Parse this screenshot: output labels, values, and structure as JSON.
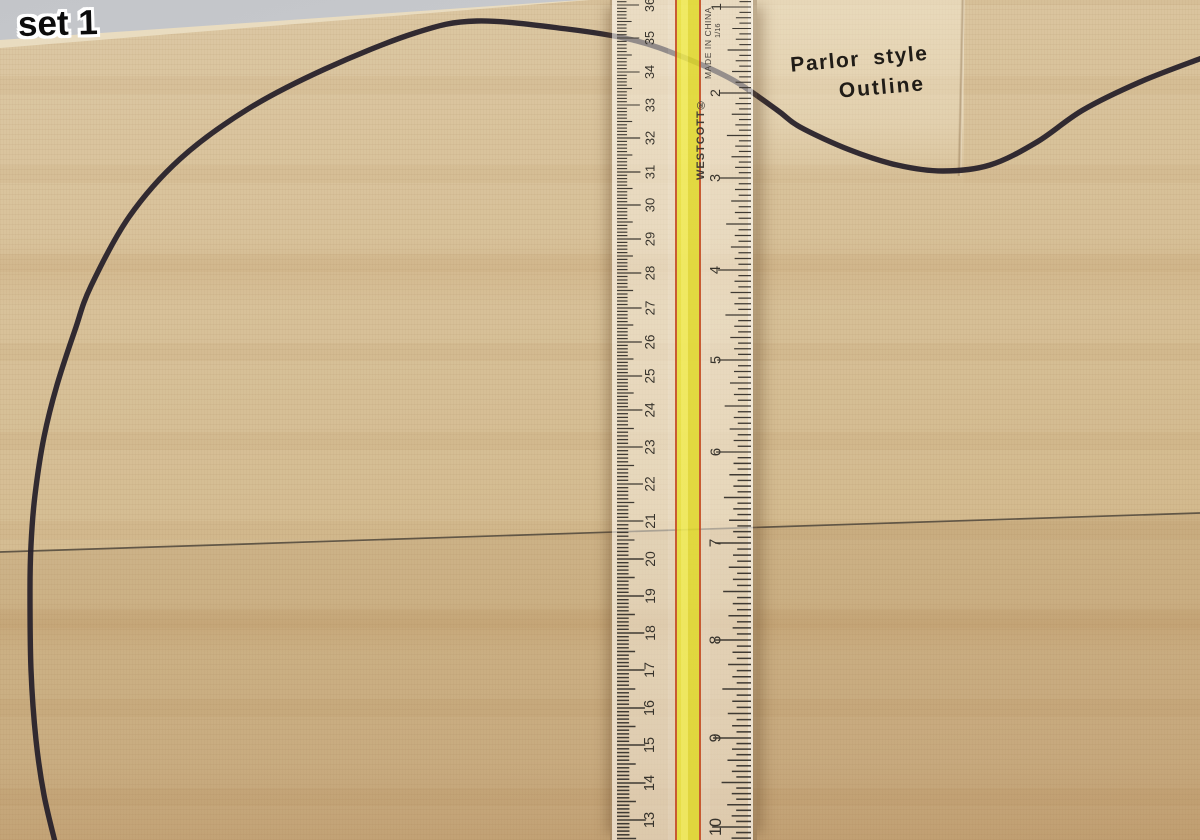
{
  "overlay_label": {
    "text": "set 1"
  },
  "template": {
    "line1": "Parlor style",
    "line2": "Outline"
  },
  "ruler": {
    "brand": "WESTCOTT®",
    "made_in": "MADE IN CHINA",
    "fraction": "1/16",
    "cm_marks": [
      [
        36,
        5
      ],
      [
        35,
        38
      ],
      [
        34,
        72
      ],
      [
        33,
        105
      ],
      [
        32,
        138
      ],
      [
        31,
        172
      ],
      [
        30,
        205
      ],
      [
        29,
        239
      ],
      [
        28,
        273
      ],
      [
        27,
        308
      ],
      [
        26,
        342
      ],
      [
        25,
        376
      ],
      [
        24,
        410
      ],
      [
        23,
        447
      ],
      [
        22,
        484
      ],
      [
        21,
        521
      ],
      [
        20,
        559
      ],
      [
        19,
        596
      ],
      [
        18,
        633
      ],
      [
        17,
        670
      ],
      [
        16,
        708
      ],
      [
        15,
        745
      ],
      [
        14,
        783
      ],
      [
        13,
        820
      ]
    ],
    "inch_marks": [
      [
        1,
        7
      ],
      [
        2,
        93
      ],
      [
        3,
        178
      ],
      [
        4,
        270
      ],
      [
        5,
        360
      ],
      [
        6,
        452
      ],
      [
        7,
        543
      ],
      [
        8,
        640
      ],
      [
        9,
        738
      ],
      [
        10,
        827
      ]
    ],
    "colors": {
      "tick": "#3f3a33",
      "number": "#37332c"
    }
  },
  "drawing": {
    "outline_points": [
      [
        55,
        842
      ],
      [
        44,
        795
      ],
      [
        36,
        740
      ],
      [
        31,
        670
      ],
      [
        30,
        590
      ],
      [
        31,
        545
      ],
      [
        35,
        495
      ],
      [
        44,
        437
      ],
      [
        57,
        385
      ],
      [
        75,
        330
      ],
      [
        91,
        286
      ],
      [
        129,
        217
      ],
      [
        180,
        159
      ],
      [
        248,
        109
      ],
      [
        325,
        69
      ],
      [
        415,
        33
      ],
      [
        477,
        21
      ],
      [
        567,
        29
      ],
      [
        633,
        40
      ],
      [
        683,
        57
      ],
      [
        733,
        80
      ],
      [
        777,
        110
      ],
      [
        800,
        127
      ],
      [
        850,
        150
      ],
      [
        897,
        165
      ],
      [
        943,
        171
      ],
      [
        990,
        165
      ],
      [
        1037,
        142
      ],
      [
        1083,
        110
      ],
      [
        1140,
        82
      ],
      [
        1202,
        58
      ]
    ],
    "centerline": [
      [
        0,
        552
      ],
      [
        1200,
        513
      ]
    ],
    "stroke": "#28222b",
    "centerline_color": "#4d4539"
  }
}
